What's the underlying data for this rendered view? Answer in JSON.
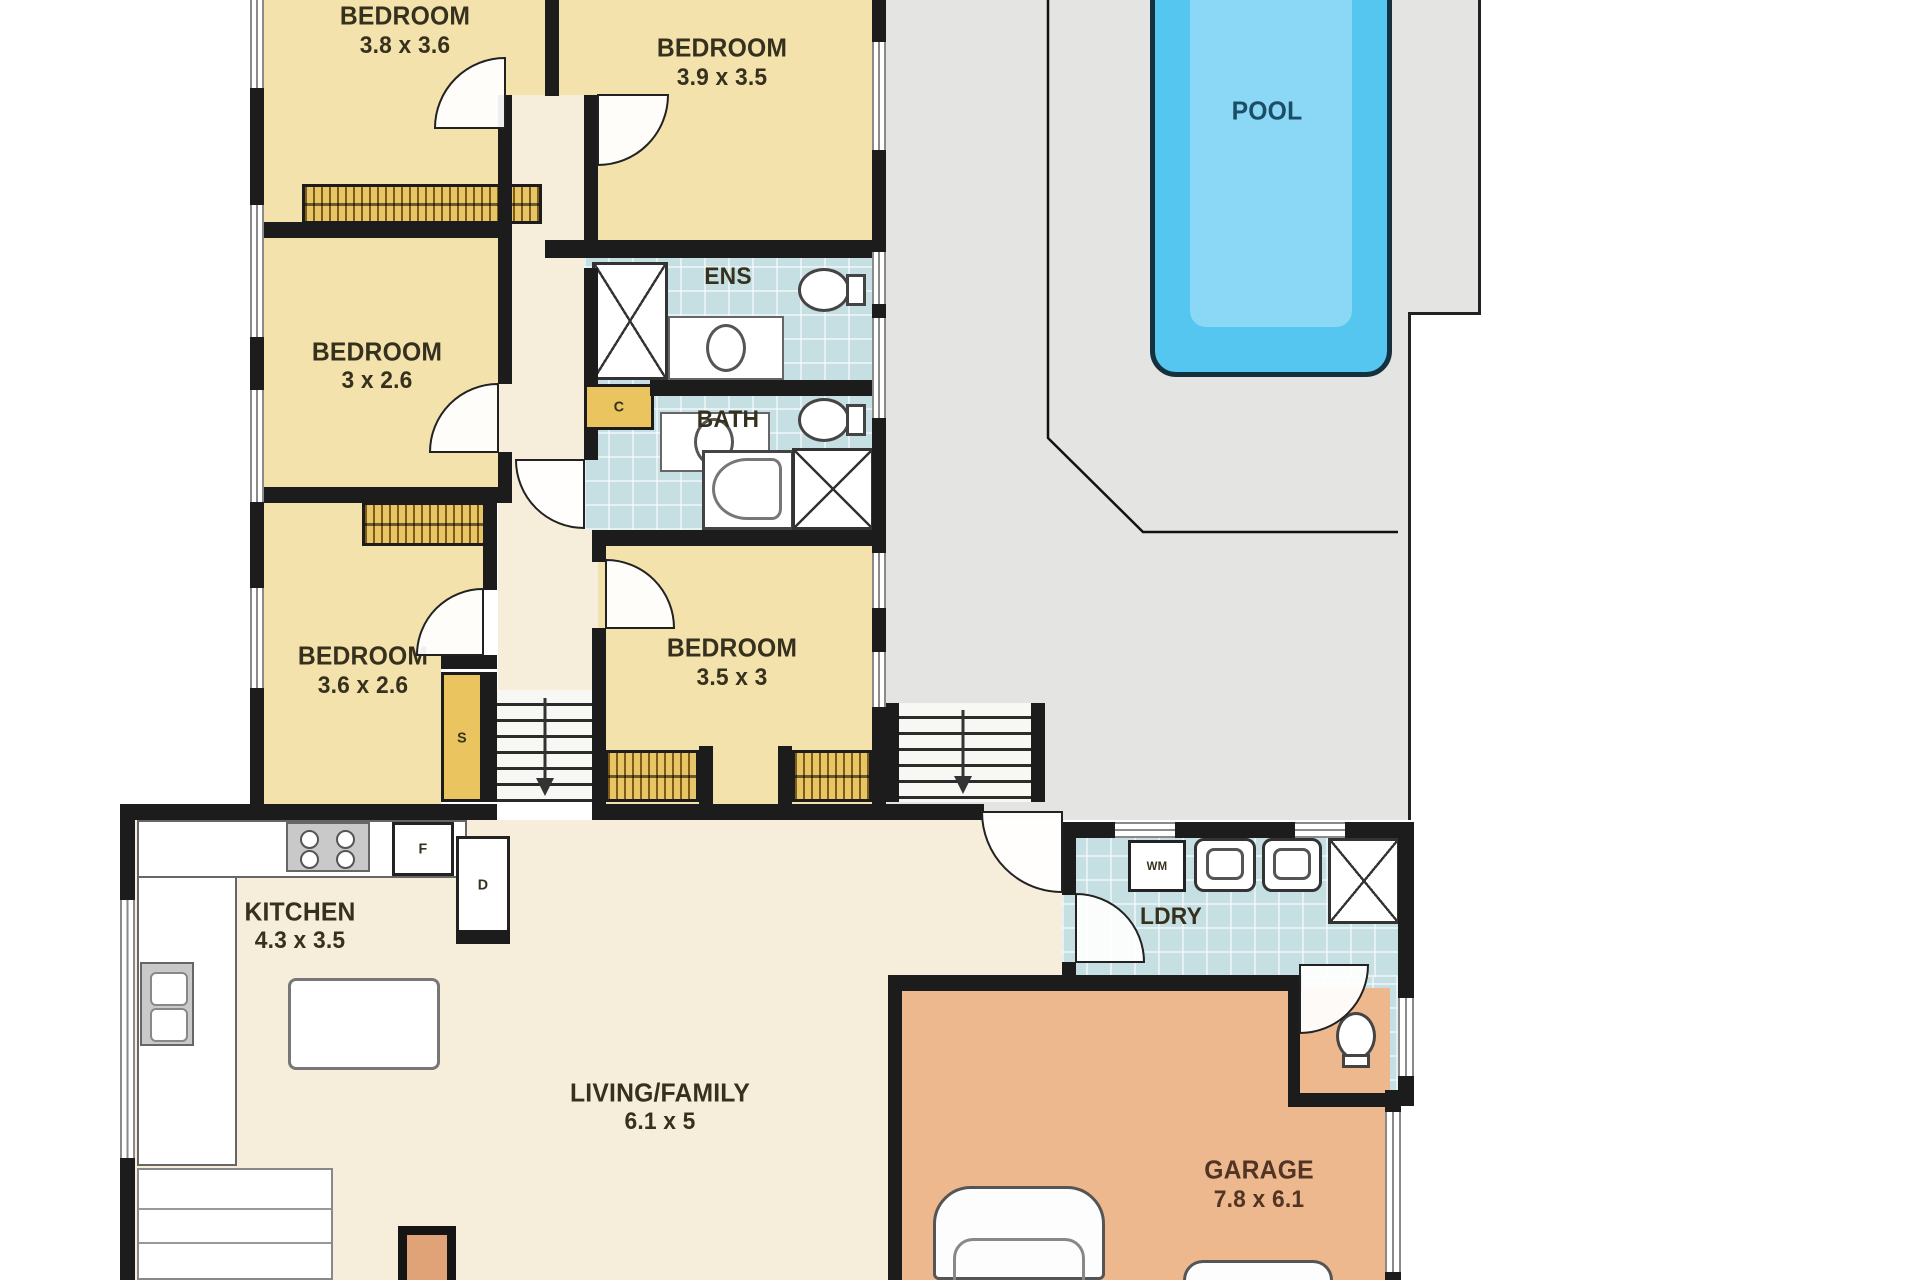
{
  "plan": {
    "rooms": {
      "bedroom1": {
        "name": "BEDROOM",
        "dims": "3.8 x 3.6"
      },
      "bedroom2": {
        "name": "BEDROOM",
        "dims": "3.9 x 3.5"
      },
      "bedroom3": {
        "name": "BEDROOM",
        "dims": "3 x 2.6"
      },
      "bedroom4": {
        "name": "BEDROOM",
        "dims": "3.6 x 2.6"
      },
      "bedroom5": {
        "name": "BEDROOM",
        "dims": "3.5 x 3"
      },
      "ensuite": {
        "name": "ENS"
      },
      "bathroom": {
        "name": "BATH"
      },
      "kitchen": {
        "name": "KITCHEN",
        "dims": "4.3 x 3.5"
      },
      "living": {
        "name": "LIVING/FAMILY",
        "dims": "6.1 x 5"
      },
      "laundry": {
        "name": "LDRY"
      },
      "garage": {
        "name": "GARAGE",
        "dims": "7.8 x 6.1"
      },
      "pool": {
        "name": "POOL"
      }
    },
    "cupboard_labels": {
      "fridge": "F",
      "pantry": "D",
      "linen": "S",
      "cupboard": "C",
      "washing_machine": "WM"
    },
    "colors": {
      "wall": "#1c1c1c",
      "bedroom_floor": "#f3e2ab",
      "hall_floor": "#f6eeda",
      "tile": "#c6dfe2",
      "patio": "#e4e4e2",
      "garage_floor": "#edb88e",
      "pool_water": "#55c6f0",
      "pool_inner": "#8ad8f6",
      "wardrobe": "#e7c566",
      "cupboard": "#eac45f",
      "label_ink": "#36311f",
      "pool_ink": "#1c4d67"
    }
  }
}
